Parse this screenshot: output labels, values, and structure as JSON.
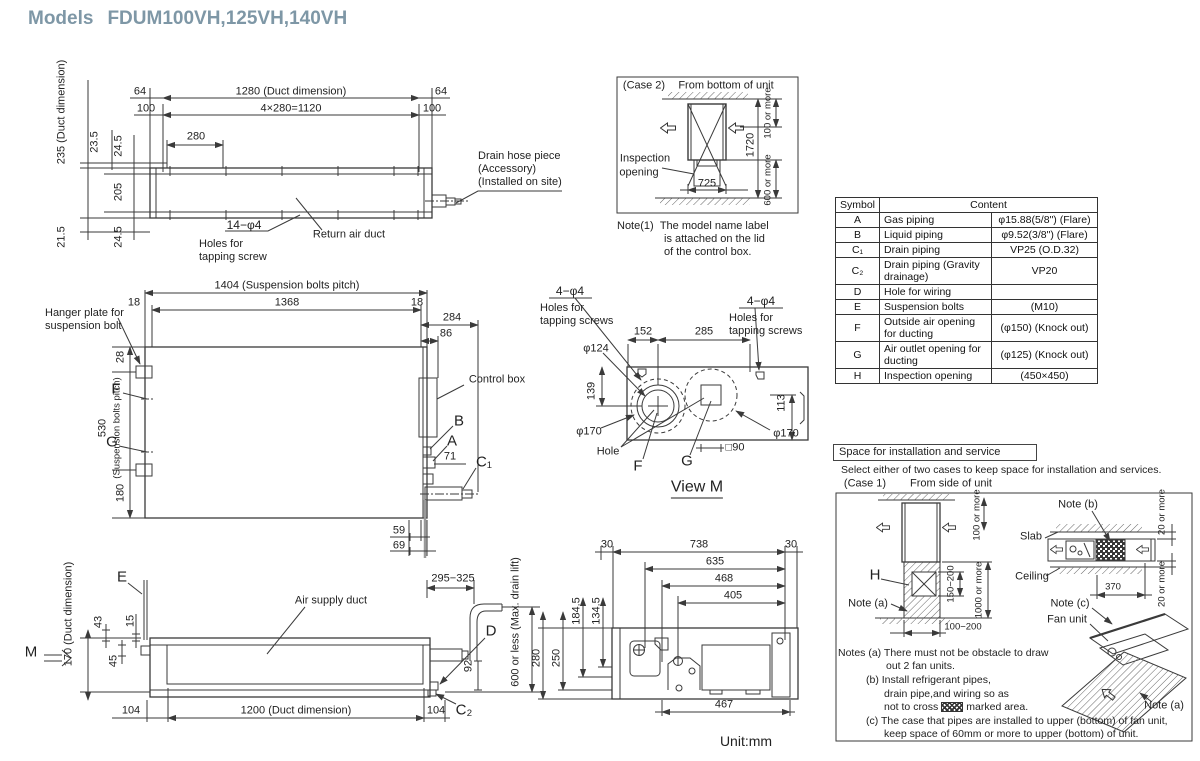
{
  "title": {
    "label": "Models",
    "models": "FDUM100VH,125VH,140VH"
  },
  "unit_note": "Unit:mm",
  "top_view": {
    "d64l": "64",
    "d1280": "1280 (Duct dimension)",
    "d64r": "64",
    "d100l": "100",
    "d1120": "4×280=1120",
    "d100r": "100",
    "d280": "280",
    "d235": "235 (Duct dimension)",
    "d23_5": "23.5",
    "d24_5t": "24.5",
    "d205": "205",
    "d24_5b": "24.5",
    "d21_5": "21.5",
    "holes1": "14−φ4",
    "holes2": "Holes for",
    "holes3": "tapping screw",
    "return_duct": "Return air duct",
    "drain1": "Drain hose piece",
    "drain2": "(Accessory)",
    "drain3": "(Installed on site)"
  },
  "case2": {
    "label": "(Case 2)",
    "sub": "From bottom of unit",
    "d1720": "1720",
    "d100": "100 or more",
    "d600": "600 or more",
    "d725": "725",
    "insp1": "Inspection",
    "insp2": "opening",
    "note_label": "Note(1)",
    "note1": "The model name label",
    "note2": "is attached on the lid",
    "note3": "of the control box."
  },
  "table": {
    "h_symbol": "Symbol",
    "h_content": "Content",
    "rows": [
      {
        "sym": "A",
        "name": "Gas piping",
        "val": "φ15.88(5/8\") (Flare)"
      },
      {
        "sym": "B",
        "name": "Liquid piping",
        "val": "φ9.52(3/8\") (Flare)"
      },
      {
        "sym": "C₁",
        "name": "Drain piping",
        "val": "VP25 (O.D.32)"
      },
      {
        "sym": "C₂",
        "name": "Drain piping (Gravity drainage)",
        "val": "VP20"
      },
      {
        "sym": "D",
        "name": "Hole for wiring",
        "val": ""
      },
      {
        "sym": "E",
        "name": "Suspension bolts",
        "val": "(M10)"
      },
      {
        "sym": "F",
        "name": "Outside air opening for ducting",
        "val": "(φ150) (Knock out)"
      },
      {
        "sym": "G",
        "name": "Air outlet opening for ducting",
        "val": "(φ125) (Knock out)"
      },
      {
        "sym": "H",
        "name": "Inspection opening",
        "val": "(450×450)"
      }
    ]
  },
  "mid_view": {
    "d1404": "1404 (Suspension bolts pitch)",
    "d18l": "18",
    "d1368": "1368",
    "d18r": "18",
    "d284": "284",
    "d86": "86",
    "hanger1": "Hanger plate for",
    "hanger2": "suspension bolt",
    "d28": "28",
    "d530": "530",
    "d530b": "(Suspension bolts pitch)",
    "d180": "180",
    "f": "F",
    "g": "G",
    "control_box": "Control box",
    "b": "B",
    "a": "A",
    "d71": "71",
    "c1": "C₁",
    "d59": "59",
    "d69": "69"
  },
  "view_m": {
    "tap_l1": "4−φ4",
    "tap_l2": "Holes for",
    "tap_l3": "tapping screws",
    "tap_r1": "4−φ4",
    "tap_r2": "Holes for",
    "tap_r3": "tapping screws",
    "d152": "152",
    "d285": "285",
    "d124": "φ124",
    "d139": "139",
    "d170l": "φ170",
    "d113": "113",
    "d170r": "φ170",
    "hole": "Hole",
    "f": "F",
    "g": "G",
    "d90": "□90",
    "title": "View M"
  },
  "front_view": {
    "e": "E",
    "m": "M",
    "d43": "43",
    "d15": "15",
    "d45": "45",
    "d170": "170 (Duct dimension)",
    "air_duct": "Air supply duct",
    "d104l": "104",
    "d1200": "1200 (Duct dimension)",
    "d104r": "104",
    "d295": "295−325",
    "d600": "600 or less (Max. drain lift)",
    "d92": "92",
    "d": "D",
    "c2": "C₂"
  },
  "bottom_view": {
    "d30l": "30",
    "d738": "738",
    "d30r": "30",
    "d635": "635",
    "d468": "468",
    "d405": "405",
    "d467": "467",
    "d184": "184.5",
    "d134": "134.5",
    "d280": "280",
    "d250": "250"
  },
  "install": {
    "header": "Space for installation and service",
    "intro": "Select either of two cases to keep space for installation and services.",
    "case1": "(Case 1)",
    "case1sub": "From side of unit",
    "d100": "100 or more",
    "h": "H",
    "note_a": "Note (a)",
    "d150": "150−200",
    "d1000": "1000 or more",
    "d100_200": "100−200",
    "note_b": "Note (b)",
    "slab": "Slab",
    "ceiling": "Ceiling",
    "d20t": "20 or more",
    "d20b": "20 or more",
    "d370": "370",
    "note_c": "Note (c)",
    "fan_unit": "Fan unit",
    "note_a2": "Note (a)"
  },
  "notes": {
    "l1": "Notes (a)  There must not be obstacle to draw",
    "l2": "out 2 fan units.",
    "l3": "(b)  Install refrigerant pipes,",
    "l4": "drain pipe,and wiring so as",
    "l5a": "not to cross",
    "l5b": "marked area.",
    "l6": "(c)  The case that pipes are installed to upper (bottom) of fan unit,",
    "l7": "keep space of 60mm or more to upper (bottom) of unit."
  }
}
